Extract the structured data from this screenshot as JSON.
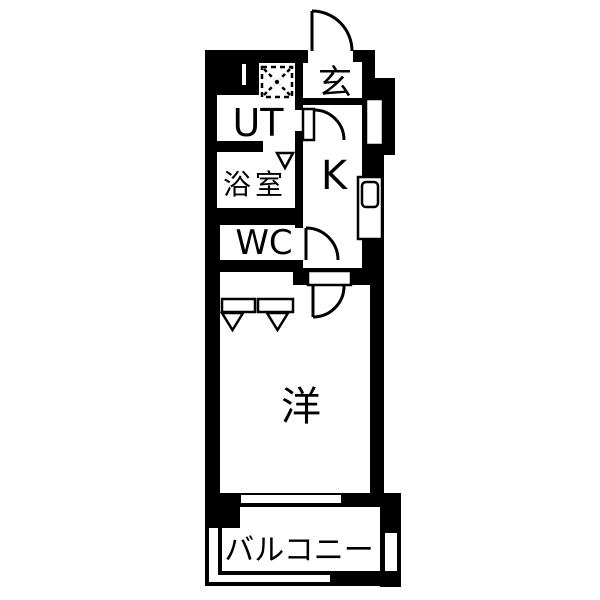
{
  "floorplan": {
    "type": "apartment-floor-plan",
    "rooms": {
      "entrance": {
        "label": "玄"
      },
      "utility": {
        "label": "UT"
      },
      "bathroom": {
        "label": "浴室"
      },
      "toilet": {
        "label": "WC"
      },
      "kitchen": {
        "label": "K"
      },
      "western_room": {
        "label": "洋"
      },
      "balcony": {
        "label": "バルコニー"
      }
    },
    "symbols": {
      "washing_machine": "dashed-square-with-cross",
      "door_swings": 4,
      "folding_door_triangles": 3
    },
    "colors": {
      "wall": "#000000",
      "floor": "#ffffff"
    }
  }
}
